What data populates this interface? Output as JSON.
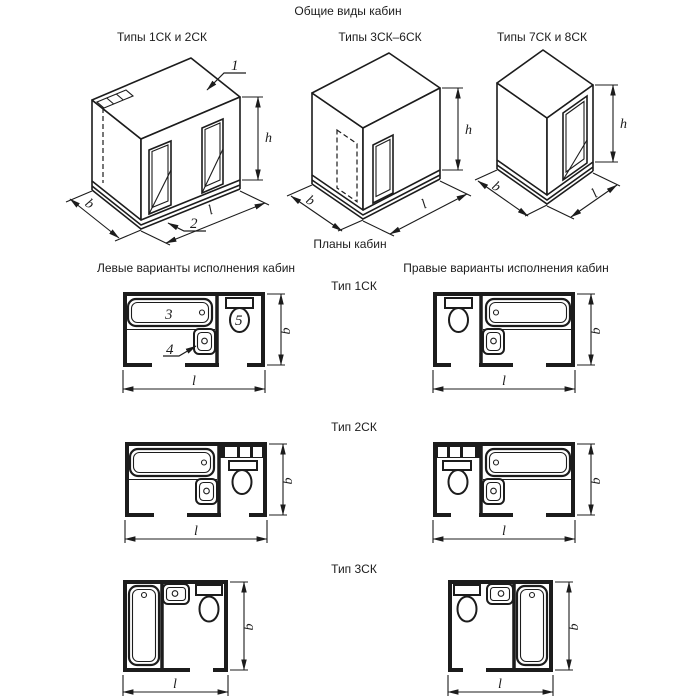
{
  "document": {
    "title": "Общие виды кабин",
    "plans_title": "Планы кабин",
    "left_column_title": "Левые варианты исполнения кабин",
    "right_column_title": "Правые варианты исполнения кабин"
  },
  "views": {
    "view1_caption": "Типы 1СК и 2СК",
    "view2_caption": "Типы 3СК–6СК",
    "view3_caption": "Типы 7СК и 8СК"
  },
  "rows": {
    "row1_label": "Тип 1СК",
    "row2_label": "Тип 2СК",
    "row3_label": "Тип 3СК"
  },
  "dimension_labels": {
    "height": "h",
    "width": "b",
    "length": "l"
  },
  "callouts": {
    "ceiling_panel": "1",
    "floor_panel": "2",
    "bathtub": "3",
    "washbasin": "4",
    "toilet": "5"
  },
  "colors": {
    "line": "#1c1c1c",
    "background": "#ffffff"
  }
}
